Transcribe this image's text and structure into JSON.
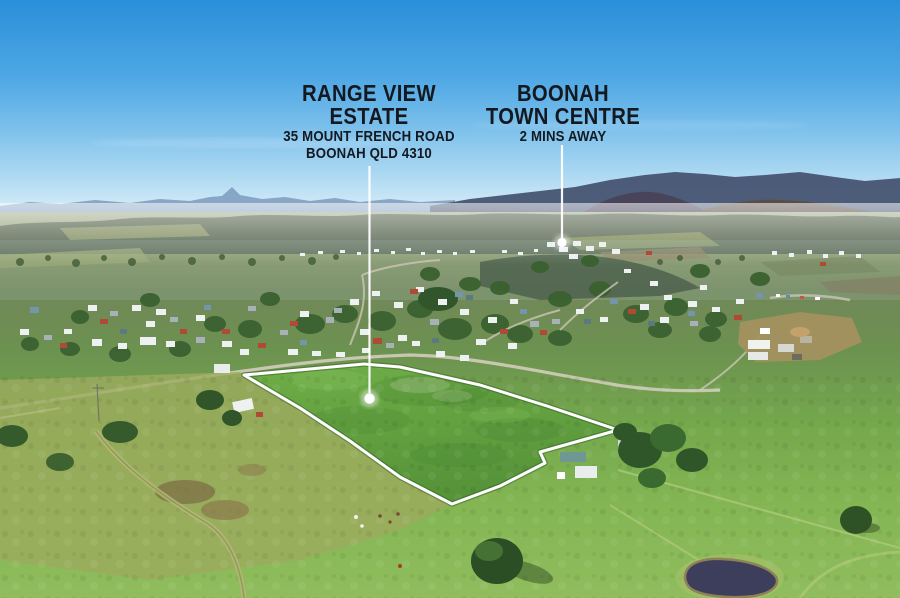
{
  "image": {
    "width": 900,
    "height": 598
  },
  "annotations": {
    "estate_label": {
      "title_line1": "RANGE VIEW",
      "title_line2": "ESTATE",
      "subtitle_line1": "35 MOUNT FRENCH ROAD",
      "subtitle_line2": "BOONAH QLD 4310"
    },
    "town_label": {
      "title_line1": "BOONAH",
      "title_line2": "TOWN CENTRE",
      "subtitle_line1": "2 MINS AWAY"
    },
    "pointers": {
      "estate": {
        "x": 369.5,
        "y1": 166,
        "y2": 393,
        "dot_cx": 369.5,
        "dot_cy": 398.5,
        "dot_r": 5.2
      },
      "town": {
        "x": 562,
        "y1": 145,
        "y2": 238,
        "dot_cx": 562,
        "dot_cy": 242.5,
        "dot_r": 4.6
      }
    },
    "boundary": {
      "points": "244,375 364,364 400,367 480,385 547,406 618,430 540,452 545,463 500,486 452,504 400,477 350,441 300,408",
      "stroke": "#ffffff",
      "stroke_width": 3
    }
  },
  "colors": {
    "label_text": "#14181f",
    "pointer_white": "#ffffff",
    "sky_top": "#2a8fd9",
    "sky_horizon": "#e0f0f6",
    "mountain_far": "#819fc0",
    "mountain_near": "#485672",
    "treeline": "#51604a",
    "field_bright": "#8cbb59",
    "property_green": "#68a941",
    "roof_red": "#b04a36",
    "roof_blue": "#7396ad",
    "dam_water": "#3d3d5c"
  }
}
